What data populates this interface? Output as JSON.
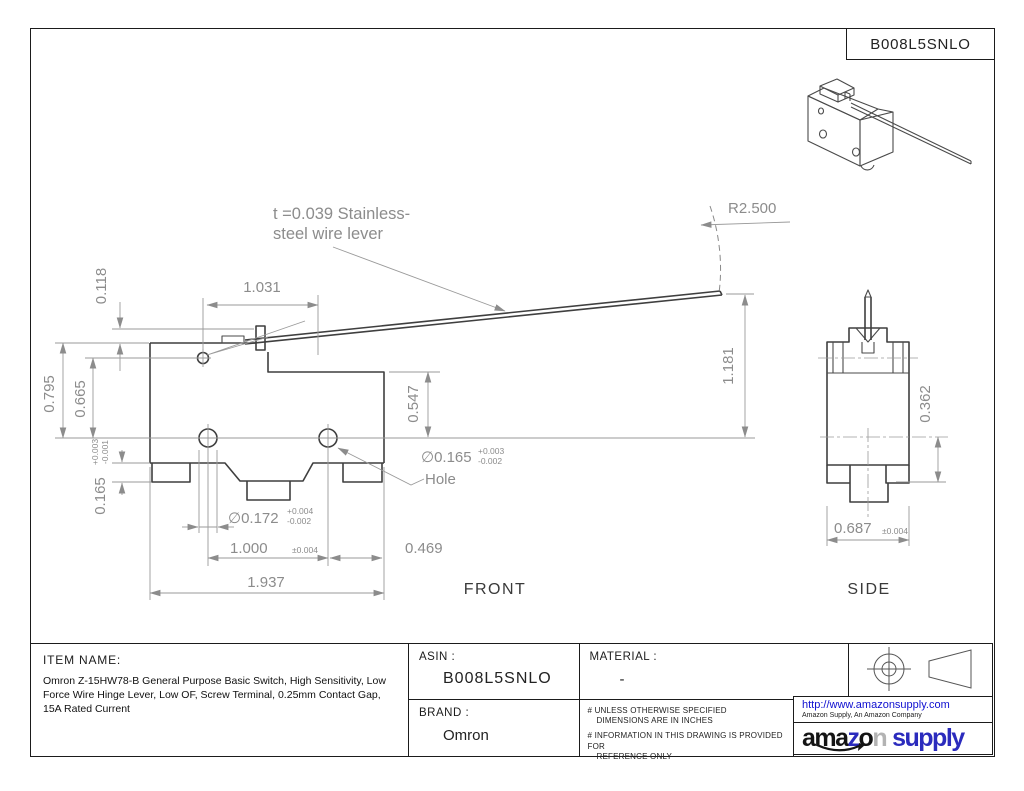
{
  "page": {
    "title_box": "B008L5SNLO"
  },
  "colors": {
    "logo_blue": "#2b2bbd",
    "url_blue": "#0f0fd0",
    "object_line": "#3f3f3f",
    "dim_line": "#9a9a9a",
    "dim_text": "#8c8c8c"
  },
  "annotations": {
    "lever_note_line1": "t =0.039 Stainless-",
    "lever_note_line2": "steel wire lever",
    "radius_label": "R2.500",
    "hole_label": "Hole",
    "front_label": "FRONT",
    "side_label": "SIDE"
  },
  "dims": {
    "d118": "0.118",
    "d1031": "1.031",
    "d795": "0.795",
    "d665": "0.665",
    "d165L": "0.165",
    "d165L_tp": "+0.003",
    "d165L_tm": "-0.001",
    "d547": "0.547",
    "holeDia": "∅0.165",
    "holeDia_tp": "+0.003",
    "holeDia_tm": "-0.002",
    "d172": "∅0.172",
    "d172_tp": "+0.004",
    "d172_tm": "-0.002",
    "d1000": "1.000",
    "d1000_tol": "±0.004",
    "d469": "0.469",
    "d1937": "1.937",
    "d1181": "1.181",
    "d362": "0.362",
    "d687": "0.687",
    "d687_tol": "±0.004"
  },
  "titleblock": {
    "item_name_label": "ITEM NAME:",
    "item_name_text": "Omron Z-15HW78-B General Purpose Basic Switch, High Sensitivity, Low Force Wire Hinge Lever, Low OF, Screw Terminal, 0.25mm Contact Gap, 15A Rated Current",
    "asin_label": "ASIN :",
    "asin_value": "B008L5SNLO",
    "material_label": "MATERIAL :",
    "material_value": "-",
    "brand_label": "BRAND :",
    "brand_value": "Omron",
    "note1_l1": "# UNLESS OTHERWISE SPECIFIED",
    "note1_l2": "DIMENSIONS ARE IN INCHES",
    "note2_l1": "# INFORMATION IN THIS DRAWING IS PROVIDED FOR",
    "note2_l2": "REFERENCE ONLY"
  },
  "footer": {
    "url": "http://www.amazonsupply.com",
    "tagline": "Amazon Supply, An Amazon Company",
    "logo_ama": "ama",
    "logo_z": "z",
    "logo_o": "o",
    "logo_n": "n",
    "logo_supply": "supply"
  }
}
